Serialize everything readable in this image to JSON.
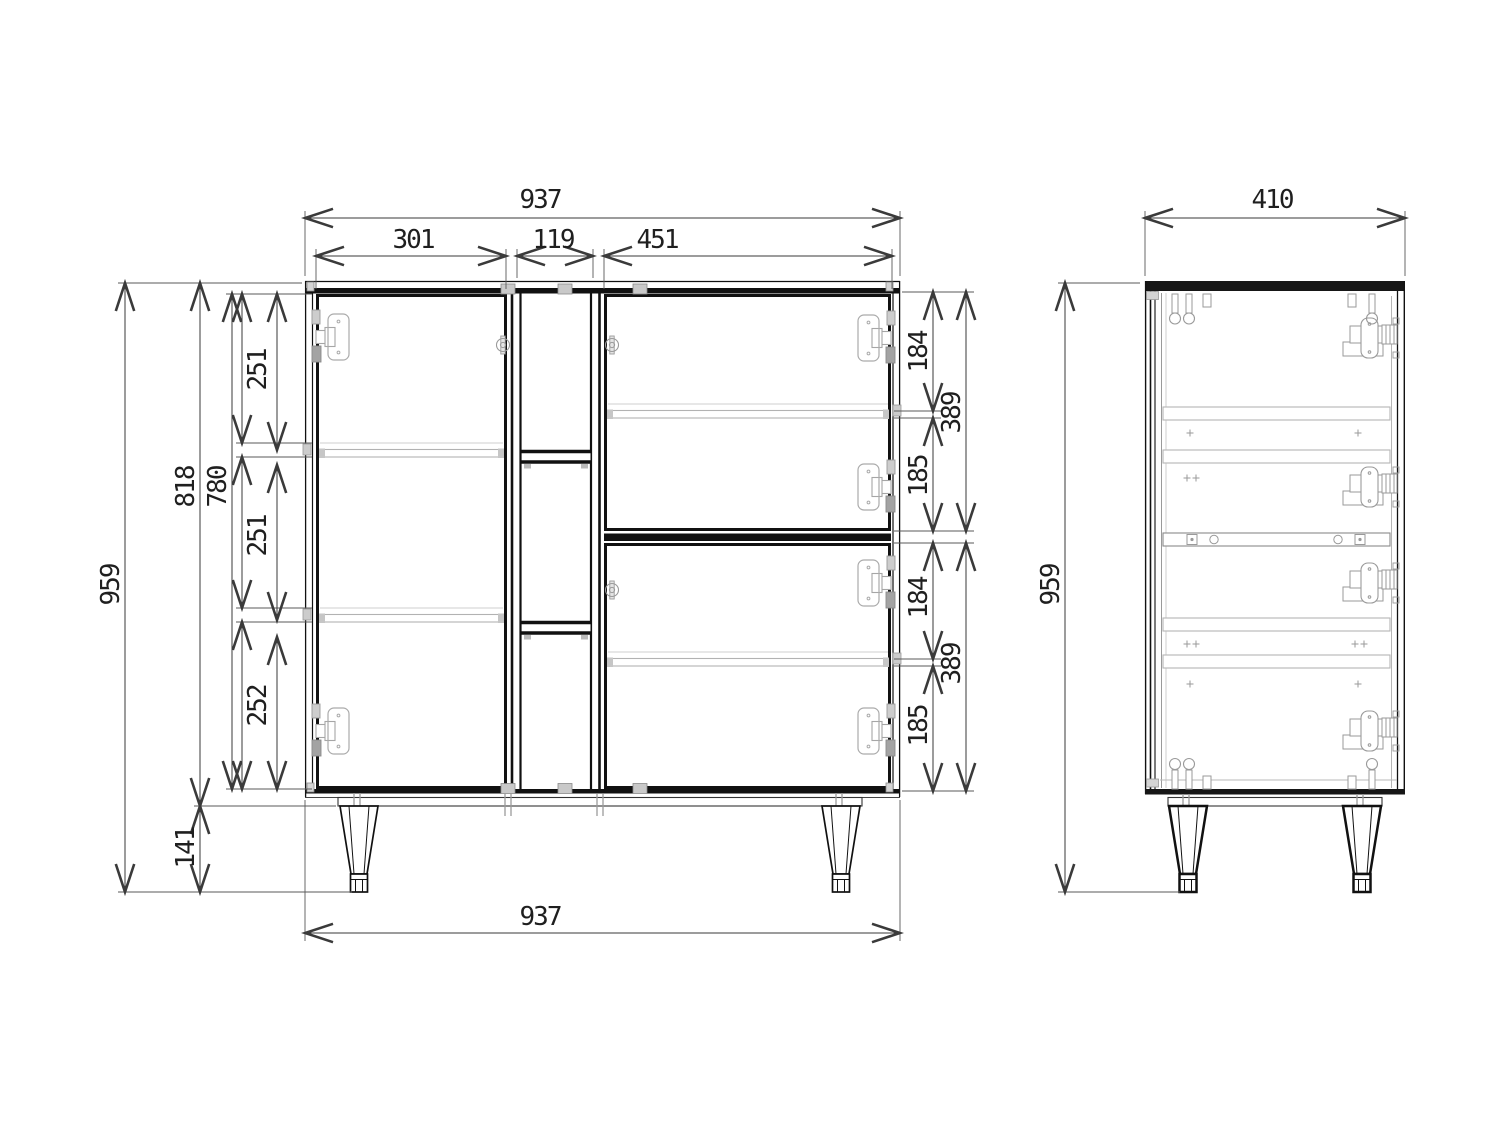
{
  "drawing_type": "cabinet technical drawing, front and side orthographic views",
  "style": {
    "background": "#ffffff",
    "line_color": "#111111",
    "dim_color": "#3a3a3a",
    "hardware_color": "#9a9a9a"
  },
  "dims": {
    "front": {
      "width_top": "937",
      "left_door": "301",
      "center_section": "119",
      "right_door": "451",
      "height_total": "959",
      "height_body": "818",
      "height_interior": "780",
      "comp_top": "251",
      "comp_mid": "251",
      "comp_bottom": "252",
      "legs": "141",
      "rt_hinge_top": "184",
      "rt_door": "389",
      "rt_hinge_bottom": "185",
      "rb_hinge_top": "184",
      "rb_door": "389",
      "rb_hinge_bottom": "185",
      "width_bottom": "937"
    },
    "side": {
      "depth": "410",
      "height_total": "959"
    }
  }
}
